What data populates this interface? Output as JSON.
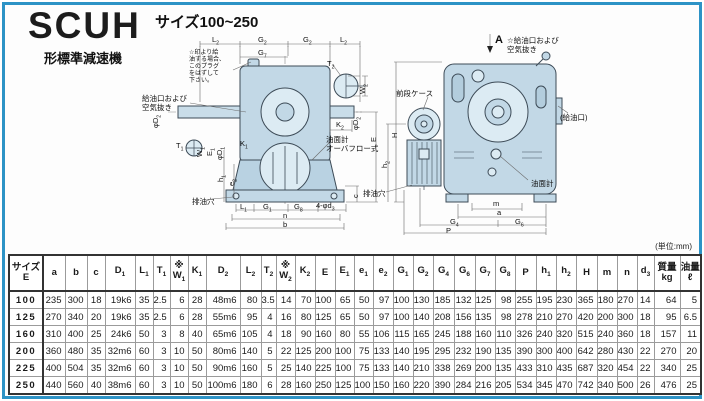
{
  "header": {
    "model": "SCUH",
    "model_suffix": "形標準減速機",
    "size_range": "サイズ100~250",
    "unit_note": "(単位:mm)"
  },
  "front_view": {
    "note": "☆印より給\n油する場合、\nこのプラグ\nをはずして\n下さい。",
    "labels": [
      {
        "n": "dim-L2-left",
        "t": "L",
        "s": "2",
        "x": 212,
        "y": 36
      },
      {
        "n": "dim-G2-left",
        "t": "G",
        "s": "2",
        "x": 258,
        "y": 36
      },
      {
        "n": "dim-G2-right",
        "t": "G",
        "s": "2",
        "x": 303,
        "y": 36
      },
      {
        "n": "dim-L2-right",
        "t": "L",
        "s": "2",
        "x": 340,
        "y": 36
      },
      {
        "n": "dim-G7",
        "t": "G",
        "s": "7",
        "x": 258,
        "y": 49
      },
      {
        "n": "dim-T2",
        "t": "T",
        "s": "2",
        "x": 327,
        "y": 60
      },
      {
        "n": "dim-W2",
        "t": "W",
        "s": "2",
        "x": 359,
        "y": 94,
        "r": 1
      },
      {
        "n": "label-oil-port-vent",
        "t": "給油口および\n空気抜き",
        "x": 142,
        "y": 95
      },
      {
        "n": "dim-phiD2-left",
        "t": "φD",
        "s": "2",
        "x": 152,
        "y": 128,
        "r": 1
      },
      {
        "n": "dim-phiD2-right",
        "t": "φD",
        "s": "2",
        "x": 352,
        "y": 130,
        "r": 1
      },
      {
        "n": "dim-K2",
        "t": "K",
        "s": "2",
        "x": 336,
        "y": 121
      },
      {
        "n": "dim-E",
        "t": "E",
        "x": 370,
        "y": 142,
        "r": 1
      },
      {
        "n": "label-oil-gauge-front",
        "t": "油面計\nオーバフロー式",
        "x": 326,
        "y": 136
      },
      {
        "n": "dim-T1",
        "t": "T",
        "s": "1",
        "x": 176,
        "y": 142
      },
      {
        "n": "dim-W1",
        "t": "W",
        "s": "1",
        "x": 196,
        "y": 157,
        "r": 1
      },
      {
        "n": "dim-E1",
        "t": "E",
        "s": "1",
        "x": 206,
        "y": 156,
        "r": 1
      },
      {
        "n": "dim-phiD1",
        "t": "φD",
        "s": "1",
        "x": 216,
        "y": 160,
        "r": 1
      },
      {
        "n": "dim-K1",
        "t": "K",
        "s": "1",
        "x": 240,
        "y": 140
      },
      {
        "n": "dim-h1",
        "t": "h",
        "s": "1",
        "x": 217,
        "y": 182,
        "r": 1
      },
      {
        "n": "dim-e2",
        "t": "e",
        "s": "2",
        "x": 228,
        "y": 186,
        "r": 1
      },
      {
        "n": "label-drain-front",
        "t": "排油穴",
        "x": 192,
        "y": 198
      },
      {
        "n": "dim-L1",
        "t": "L",
        "s": "1",
        "x": 240,
        "y": 203
      },
      {
        "n": "dim-G1",
        "t": "G",
        "s": "1",
        "x": 263,
        "y": 203
      },
      {
        "n": "dim-G8",
        "t": "G",
        "s": "8",
        "x": 294,
        "y": 203
      },
      {
        "n": "dim-4-phid3",
        "t": "4-φd",
        "s": "3",
        "x": 316,
        "y": 202
      },
      {
        "n": "dim-n",
        "t": "n",
        "x": 283,
        "y": 212
      },
      {
        "n": "dim-b",
        "t": "b",
        "x": 283,
        "y": 221
      },
      {
        "n": "dim-c",
        "t": "c",
        "x": 352,
        "y": 198,
        "r": 1
      }
    ]
  },
  "side_view": {
    "labels": [
      {
        "n": "label-section-A",
        "t": "A",
        "x": 495,
        "y": 36,
        "fs": 11,
        "b": 1
      },
      {
        "n": "label-oil-vent-side",
        "t": "☆給油口および\n空気抜き",
        "x": 507,
        "y": 37
      },
      {
        "n": "label-front-case",
        "t": "前段ケース",
        "x": 396,
        "y": 90
      },
      {
        "n": "label-oil-fill",
        "t": "(給油口)",
        "x": 560,
        "y": 114
      },
      {
        "n": "dim-H",
        "t": "H",
        "x": 391,
        "y": 138,
        "r": 1
      },
      {
        "n": "dim-h2",
        "t": "h",
        "s": "2",
        "x": 381,
        "y": 168,
        "r": 1
      },
      {
        "n": "label-oil-gauge-side",
        "t": "油面計",
        "x": 531,
        "y": 180
      },
      {
        "n": "label-drain-side",
        "t": "排油穴",
        "x": 363,
        "y": 190
      },
      {
        "n": "dim-m",
        "t": "m",
        "x": 493,
        "y": 200
      },
      {
        "n": "dim-a",
        "t": "a",
        "x": 497,
        "y": 209
      },
      {
        "n": "dim-G4",
        "t": "G",
        "s": "4",
        "x": 450,
        "y": 218
      },
      {
        "n": "dim-G6",
        "t": "G",
        "s": "6",
        "x": 515,
        "y": 218
      },
      {
        "n": "dim-P",
        "t": "P",
        "x": 446,
        "y": 227
      }
    ]
  },
  "table": {
    "columns": [
      {
        "t": "サイズ",
        "t2": "E"
      },
      {
        "t": "a"
      },
      {
        "t": "b"
      },
      {
        "t": "c"
      },
      {
        "t": "D",
        "sub": "1"
      },
      {
        "t": "L",
        "sub": "1"
      },
      {
        "t": "T",
        "sub": "1"
      },
      {
        "t": "※",
        "t2": "W",
        "sub2": "1"
      },
      {
        "t": "K",
        "sub": "1"
      },
      {
        "t": "D",
        "sub": "2"
      },
      {
        "t": "L",
        "sub": "2"
      },
      {
        "t": "T",
        "sub": "2"
      },
      {
        "t": "※",
        "t2": "W",
        "sub2": "2"
      },
      {
        "t": "K",
        "sub": "2"
      },
      {
        "t": "E"
      },
      {
        "t": "E",
        "sub": "1"
      },
      {
        "t": "e",
        "sub": "1"
      },
      {
        "t": "e",
        "sub": "2"
      },
      {
        "t": "G",
        "sub": "1"
      },
      {
        "t": "G",
        "sub": "2"
      },
      {
        "t": "G",
        "sub": "4"
      },
      {
        "t": "G",
        "sub": "6"
      },
      {
        "t": "G",
        "sub": "7"
      },
      {
        "t": "G",
        "sub": "8"
      },
      {
        "t": "P"
      },
      {
        "t": "h",
        "sub": "1"
      },
      {
        "t": "h",
        "sub": "2"
      },
      {
        "t": "H"
      },
      {
        "t": "m"
      },
      {
        "t": "n"
      },
      {
        "t": "d",
        "sub": "3"
      },
      {
        "t": "質量",
        "t2": "kg"
      },
      {
        "t": "油量",
        "t2": "ℓ"
      }
    ],
    "rows": [
      {
        "size": "100",
        "values": [
          "235",
          "300",
          "18",
          "19k6",
          "35",
          "2.5",
          "6",
          "28",
          "48m6",
          "80",
          "3.5",
          "14",
          "70",
          "100",
          "65",
          "50",
          "97",
          "100",
          "130",
          "185",
          "132",
          "125",
          "98",
          "255",
          "195",
          "230",
          "365",
          "180",
          "270",
          "14",
          "64",
          "5"
        ]
      },
      {
        "size": "125",
        "values": [
          "270",
          "340",
          "20",
          "19k6",
          "35",
          "2.5",
          "6",
          "28",
          "55m6",
          "95",
          "4",
          "16",
          "80",
          "125",
          "65",
          "50",
          "97",
          "100",
          "140",
          "208",
          "156",
          "135",
          "98",
          "278",
          "210",
          "270",
          "420",
          "200",
          "300",
          "18",
          "95",
          "6.5"
        ]
      },
      {
        "size": "160",
        "values": [
          "310",
          "400",
          "25",
          "24k6",
          "50",
          "3",
          "8",
          "40",
          "65m6",
          "105",
          "4",
          "18",
          "90",
          "160",
          "80",
          "55",
          "106",
          "115",
          "165",
          "245",
          "188",
          "160",
          "110",
          "326",
          "240",
          "320",
          "515",
          "240",
          "360",
          "18",
          "157",
          "11"
        ]
      },
      {
        "size": "200",
        "values": [
          "360",
          "480",
          "35",
          "32m6",
          "60",
          "3",
          "10",
          "50",
          "80m6",
          "140",
          "5",
          "22",
          "125",
          "200",
          "100",
          "75",
          "133",
          "140",
          "195",
          "295",
          "232",
          "190",
          "135",
          "390",
          "300",
          "400",
          "642",
          "280",
          "430",
          "22",
          "270",
          "20"
        ]
      },
      {
        "size": "225",
        "values": [
          "400",
          "504",
          "35",
          "32m6",
          "60",
          "3",
          "10",
          "50",
          "90m6",
          "160",
          "5",
          "25",
          "140",
          "225",
          "100",
          "75",
          "133",
          "140",
          "210",
          "338",
          "269",
          "200",
          "135",
          "433",
          "310",
          "435",
          "687",
          "320",
          "454",
          "22",
          "340",
          "25"
        ]
      },
      {
        "size": "250",
        "values": [
          "440",
          "560",
          "40",
          "38m6",
          "60",
          "3",
          "10",
          "50",
          "100m6",
          "180",
          "6",
          "28",
          "160",
          "250",
          "125",
          "100",
          "150",
          "160",
          "220",
          "390",
          "284",
          "216",
          "205",
          "534",
          "345",
          "470",
          "742",
          "340",
          "500",
          "26",
          "476",
          "25"
        ]
      }
    ]
  }
}
